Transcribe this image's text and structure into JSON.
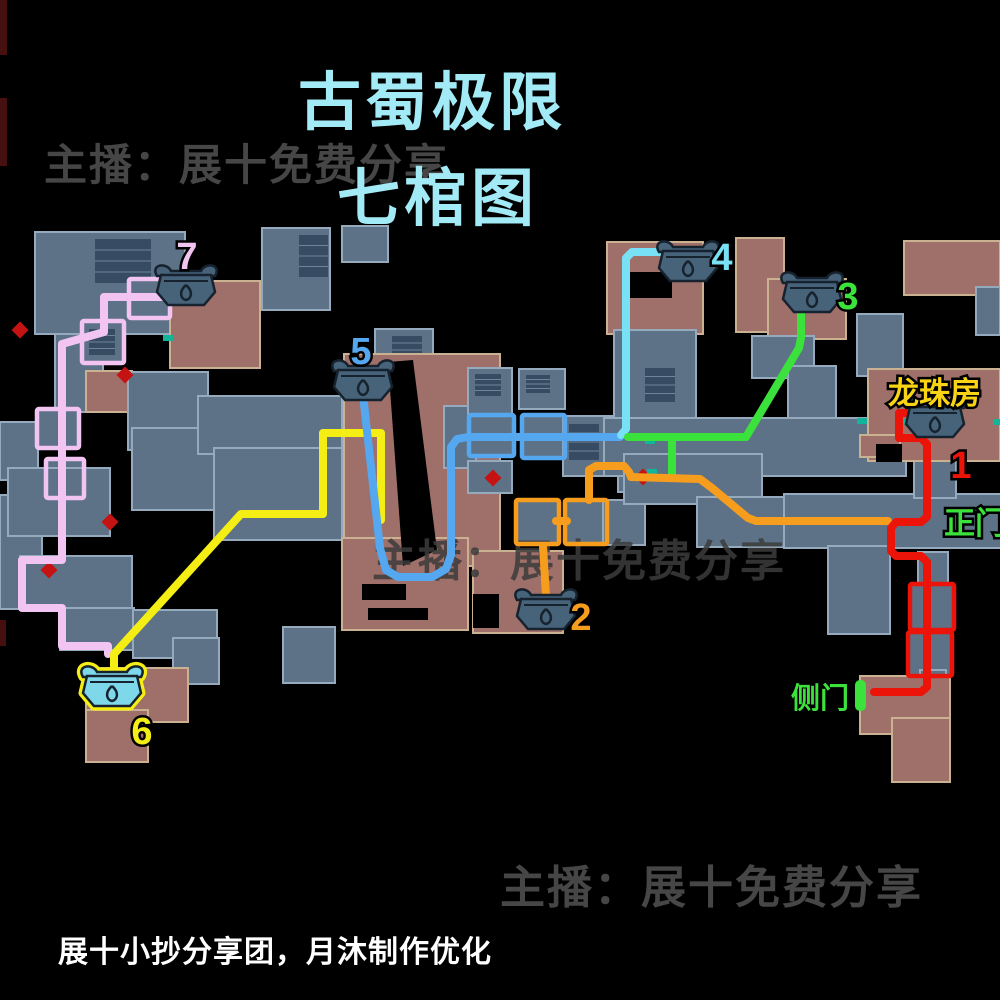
{
  "texts": {
    "title_line1": "古蜀极限",
    "title_line2": "七棺图",
    "watermark_top": "主播：展十免费分享",
    "watermark_bottom": "主播：展十免费分享",
    "watermark_map": "主播：展十免费分享",
    "credit": "展十小抄分享团，月沐制作优化"
  },
  "colors": {
    "title": "#a2eaf6",
    "watermark": "#464646",
    "credit": "#ffffff",
    "room_blue": "#5d7287",
    "room_blue_border": "#96aabd",
    "room_red": "#9f6f6a",
    "room_red_border": "#c9b191",
    "stairs": "#374c63",
    "stairs_line": "#6e849a",
    "coffin_fill": "#46637a",
    "coffin_stroke": "#16232e",
    "coffin6_fill": "#7fd7ea",
    "coffin6_ring": "#f5ee14",
    "door_green": "#3ce23c",
    "label_yellow": "#f8d414",
    "marker_red": "#c51212",
    "marker_teal": "#12b59a",
    "edge_red": "#471010"
  },
  "map": {
    "edges": [
      [
        0,
        0,
        7,
        55
      ],
      [
        0,
        98,
        7,
        68
      ],
      [
        0,
        620,
        6,
        26
      ]
    ],
    "rooms": [
      [
        "b",
        35,
        232,
        150,
        102
      ],
      [
        "s",
        95,
        239,
        56,
        44
      ],
      [
        "b",
        55,
        334,
        48,
        78
      ],
      [
        "r",
        170,
        281,
        90,
        87
      ],
      [
        "b",
        129,
        279,
        41,
        39
      ],
      [
        "b",
        82,
        321,
        42,
        42
      ],
      [
        "s",
        89,
        329,
        26,
        26
      ],
      [
        "r",
        86,
        371,
        46,
        41
      ],
      [
        "b",
        128,
        372,
        80,
        78
      ],
      [
        "b",
        0,
        422,
        38,
        58
      ],
      [
        "b",
        37,
        409,
        42,
        39
      ],
      [
        "b",
        46,
        459,
        38,
        39
      ],
      [
        "b",
        0,
        495,
        42,
        114
      ],
      [
        "b",
        8,
        468,
        102,
        68
      ],
      [
        "b",
        20,
        556,
        112,
        54
      ],
      [
        "b",
        60,
        608,
        74,
        42
      ],
      [
        "b",
        133,
        610,
        84,
        48
      ],
      [
        "b",
        173,
        638,
        46,
        46
      ],
      [
        "b",
        283,
        627,
        52,
        56
      ],
      [
        "r",
        86,
        668,
        102,
        54
      ],
      [
        "r",
        86,
        710,
        62,
        52
      ],
      [
        "b",
        132,
        428,
        84,
        82
      ],
      [
        "b",
        198,
        396,
        144,
        58
      ],
      [
        "b",
        214,
        448,
        128,
        92
      ],
      [
        "b",
        262,
        228,
        68,
        82
      ],
      [
        "s",
        299,
        235,
        29,
        42
      ],
      [
        "b",
        342,
        226,
        46,
        36
      ],
      [
        "b",
        375,
        329,
        58,
        50
      ],
      [
        "s",
        392,
        336,
        30,
        28
      ],
      [
        "r",
        344,
        354,
        156,
        212
      ],
      [
        "r",
        342,
        538,
        126,
        92
      ],
      [
        "hole",
        362,
        584,
        44,
        16
      ],
      [
        "hole",
        368,
        608,
        60,
        12
      ],
      [
        "b",
        444,
        406,
        32,
        62
      ],
      [
        "b",
        468,
        368,
        44,
        46
      ],
      [
        "s",
        475,
        374,
        26,
        22
      ],
      [
        "b",
        519,
        369,
        46,
        40
      ],
      [
        "s",
        526,
        375,
        24,
        18
      ],
      [
        "b",
        469,
        415,
        45,
        41
      ],
      [
        "b",
        522,
        415,
        43,
        43
      ],
      [
        "b",
        563,
        416,
        78,
        60
      ],
      [
        "s",
        569,
        424,
        30,
        36
      ],
      [
        "b",
        468,
        461,
        44,
        32
      ],
      [
        "b",
        618,
        456,
        54,
        36
      ],
      [
        "b",
        516,
        500,
        43,
        44
      ],
      [
        "b",
        565,
        500,
        42,
        44
      ],
      [
        "b",
        603,
        500,
        42,
        45
      ],
      [
        "r",
        473,
        551,
        90,
        82
      ],
      [
        "hole",
        473,
        594,
        26,
        34
      ],
      [
        "r",
        607,
        242,
        96,
        92
      ],
      [
        "hole",
        628,
        272,
        44,
        26
      ],
      [
        "b",
        614,
        330,
        82,
        88
      ],
      [
        "s",
        645,
        368,
        30,
        34
      ],
      [
        "r",
        736,
        238,
        48,
        94
      ],
      [
        "r",
        768,
        279,
        78,
        60
      ],
      [
        "b",
        752,
        336,
        62,
        42
      ],
      [
        "b",
        788,
        366,
        48,
        58
      ],
      [
        "r",
        904,
        241,
        96,
        54
      ],
      [
        "b",
        857,
        314,
        46,
        62
      ],
      [
        "b",
        976,
        287,
        24,
        48
      ],
      [
        "b",
        604,
        418,
        302,
        58
      ],
      [
        "b",
        624,
        454,
        138,
        50
      ],
      [
        "b",
        697,
        497,
        112,
        50
      ],
      [
        "b",
        784,
        494,
        218,
        54
      ],
      [
        "b",
        914,
        452,
        42,
        46
      ],
      [
        "b",
        828,
        546,
        62,
        88
      ],
      [
        "b",
        918,
        552,
        30,
        36
      ],
      [
        "b",
        910,
        584,
        44,
        46
      ],
      [
        "b",
        908,
        632,
        44,
        44
      ],
      [
        "b",
        920,
        670,
        26,
        26
      ],
      [
        "r",
        860,
        676,
        90,
        58
      ],
      [
        "r",
        892,
        718,
        58,
        64
      ],
      [
        "r",
        868,
        369,
        132,
        92
      ],
      [
        "r",
        860,
        435,
        40,
        22
      ],
      [
        "hole",
        876,
        444,
        26,
        18
      ]
    ],
    "crack": "388,362 413,360 437,550 403,566",
    "markers_red": [
      [
        125,
        375
      ],
      [
        110,
        522
      ],
      [
        493,
        478
      ],
      [
        643,
        477
      ],
      [
        49,
        570
      ],
      [
        20,
        330
      ]
    ],
    "markers_teal": [
      [
        168,
        338
      ],
      [
        650,
        441
      ],
      [
        652,
        472
      ],
      [
        862,
        421
      ],
      [
        902,
        422
      ],
      [
        950,
        421
      ],
      [
        998,
        422
      ]
    ],
    "routes": [
      {
        "num": "7",
        "color": "#f2c4f2",
        "points": [
          [
            166,
            297
          ],
          [
            104,
            297
          ],
          [
            104,
            332
          ],
          [
            62,
            344
          ],
          [
            62,
            560
          ],
          [
            22,
            560
          ],
          [
            22,
            608
          ],
          [
            62,
            608
          ],
          [
            62,
            646
          ],
          [
            108,
            646
          ],
          [
            108,
            654
          ]
        ],
        "boxes": [
          [
            129,
            279,
            41,
            39
          ],
          [
            82,
            321,
            42,
            42
          ],
          [
            37,
            409,
            42,
            39
          ],
          [
            46,
            459,
            38,
            39
          ]
        ],
        "num_pos": [
          187,
          256
        ],
        "coffin": [
          186,
          288
        ]
      },
      {
        "num": "6",
        "color": "#f5ee14",
        "points": [
          [
            381,
            520
          ],
          [
            381,
            433
          ],
          [
            323,
            433
          ],
          [
            323,
            514
          ],
          [
            241,
            514
          ],
          [
            114,
            654
          ],
          [
            114,
            670
          ]
        ],
        "boxes": [],
        "num_pos": [
          142,
          731
        ],
        "coffin": [
          112,
          689
        ],
        "highlight": true
      },
      {
        "num": "5",
        "color": "#55a7ef",
        "points": [
          [
            363,
            395
          ],
          [
            380,
            548
          ],
          [
            386,
            570
          ],
          [
            398,
            577
          ],
          [
            432,
            577
          ],
          [
            446,
            569
          ],
          [
            451,
            555
          ],
          [
            451,
            447
          ],
          [
            457,
            439
          ],
          [
            468,
            437
          ],
          [
            620,
            437
          ]
        ],
        "boxes": [
          [
            469,
            415,
            45,
            41
          ],
          [
            522,
            415,
            43,
            43
          ]
        ],
        "num_pos": [
          361,
          351
        ],
        "coffin": [
          363,
          383
        ]
      },
      {
        "num": "4",
        "color": "#79e1f5",
        "points": [
          [
            621,
            435
          ],
          [
            626,
            429
          ],
          [
            626,
            258
          ],
          [
            632,
            252
          ],
          [
            664,
            252
          ]
        ],
        "boxes": [],
        "num_pos": [
          722,
          257
        ],
        "coffin": [
          688,
          264
        ]
      },
      {
        "num": "3",
        "color": "#3ce23c",
        "points": [
          [
            628,
            437
          ],
          [
            746,
            437
          ],
          [
            799,
            348
          ],
          [
            801,
            338
          ],
          [
            801,
            312
          ]
        ],
        "points2": [
          [
            672,
            477
          ],
          [
            672,
            438
          ]
        ],
        "boxes": [],
        "num_pos": [
          848,
          296
        ],
        "coffin": [
          812,
          295
        ]
      },
      {
        "num": "2",
        "color": "#f79d1e",
        "points": [
          [
            589,
            500
          ],
          [
            589,
            470
          ],
          [
            596,
            466
          ],
          [
            624,
            466
          ],
          [
            629,
            472
          ],
          [
            631,
            477
          ],
          [
            700,
            479
          ],
          [
            712,
            488
          ],
          [
            748,
            518
          ],
          [
            756,
            521
          ],
          [
            888,
            521
          ]
        ],
        "points2": [
          [
            546,
            597
          ],
          [
            543,
            546
          ]
        ],
        "points3": [
          [
            556,
            521
          ],
          [
            567,
            521
          ]
        ],
        "boxes": [
          [
            516,
            500,
            43,
            44
          ],
          [
            565,
            500,
            42,
            44
          ]
        ],
        "num_pos": [
          581,
          617
        ],
        "coffin": [
          546,
          612
        ]
      },
      {
        "num": "1",
        "color": "#ec1309",
        "points": [
          [
            910,
            413
          ],
          [
            899,
            413
          ],
          [
            899,
            438
          ],
          [
            921,
            438
          ],
          [
            927,
            444
          ],
          [
            927,
            517
          ],
          [
            921,
            522
          ],
          [
            896,
            522
          ],
          [
            891,
            528
          ],
          [
            891,
            551
          ],
          [
            896,
            556
          ],
          [
            921,
            556
          ],
          [
            927,
            562
          ],
          [
            927,
            687
          ],
          [
            921,
            692
          ],
          [
            874,
            692
          ]
        ],
        "boxes": [
          [
            910,
            584,
            44,
            46
          ],
          [
            908,
            632,
            44,
            44
          ]
        ],
        "num_pos": [
          961,
          465
        ],
        "coffin": [
          935,
          420
        ]
      }
    ],
    "labels": [
      {
        "name": "dragon-pearl-room",
        "text": "龙珠房",
        "x": 888,
        "y": 404,
        "color": "#f8d414",
        "size": 31
      },
      {
        "name": "main-gate",
        "text": "正门",
        "x": 944,
        "y": 534,
        "color": "#3ce23c",
        "size": 31
      },
      {
        "name": "side-gate",
        "text": "侧门",
        "x": 791,
        "y": 708,
        "color": "#3ce23c",
        "size": 29
      }
    ],
    "door_bar": [
      855,
      680,
      11,
      31
    ],
    "map_watermark_pos": [
      372,
      576
    ]
  }
}
